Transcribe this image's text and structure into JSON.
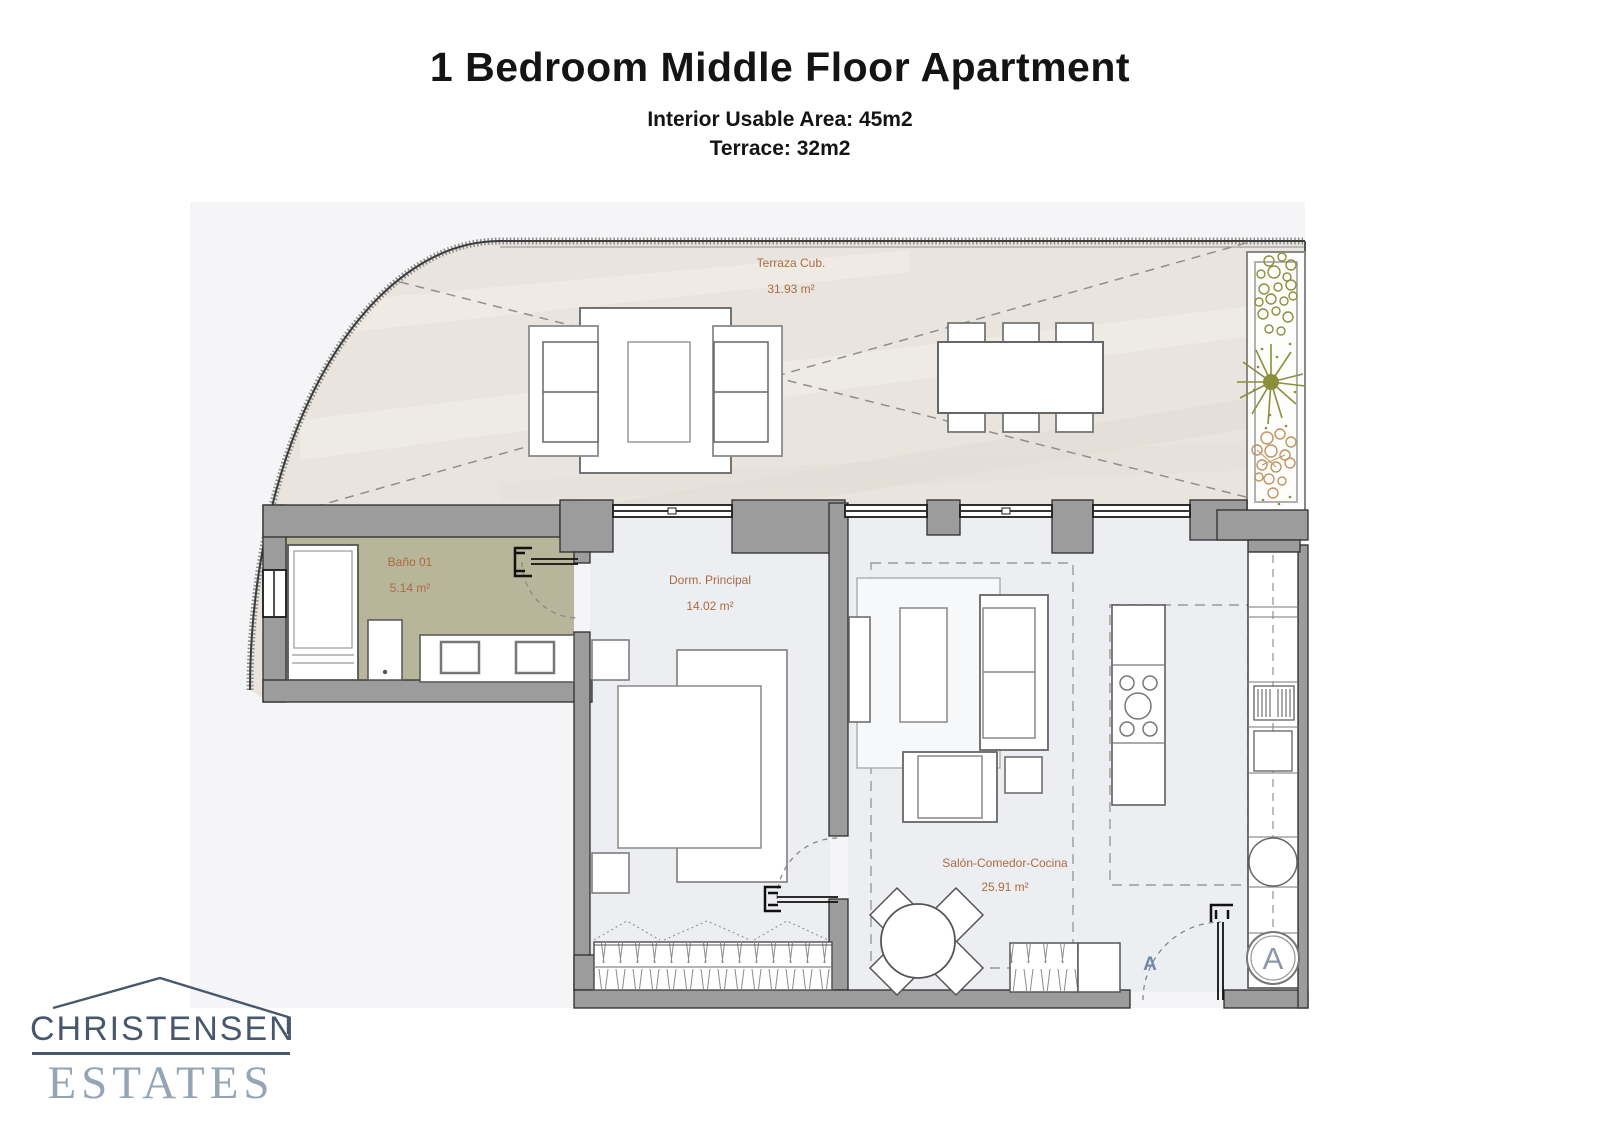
{
  "header": {
    "title": "1 Bedroom Middle Floor Apartment",
    "subtitle_area": "Interior Usable Area: 45m2",
    "subtitle_terrace": "Terrace: 32m2"
  },
  "floorplan": {
    "rooms": [
      {
        "name": "Terraza Cub.",
        "area": "31.93 m²"
      },
      {
        "name": "Baño 01",
        "area": "5.14 m²"
      },
      {
        "name": "Dorm. Principal",
        "area": "14.02 m²"
      },
      {
        "name": "Salón-Comedor-Cocina",
        "area": "25.91 m²"
      }
    ],
    "entrance_label": "A",
    "washer_label": "A",
    "colors": {
      "room_label": "#ad6a42",
      "bathroom_floor": "#b7b59a",
      "wall": "#9c9c9c",
      "terrace_floor": "#e9e5de",
      "plant_green": "#8b8f3c",
      "plant_brown": "#c0945f",
      "entrance_label_color": "#7089a8"
    }
  },
  "logo": {
    "line1": "CHRISTENSEN",
    "line2": "ESTATES"
  }
}
